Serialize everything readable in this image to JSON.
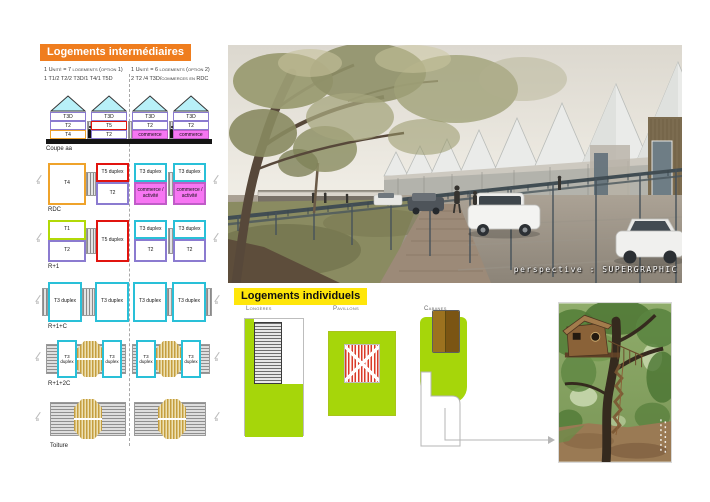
{
  "colors": {
    "orange_title_bg": "#EF7D1E",
    "yellow_title_bg": "#FFE60A",
    "cyan_border": "#29C0D8",
    "cyan_roof_fill": "#B8F0F8",
    "purple_border": "#8B7BD0",
    "red_border": "#E1140F",
    "orange_t4_border": "#EFA32B",
    "lime_green": "#A6D60A",
    "magenta_commerce": "#F776F3",
    "tan_hatch": "#C59E3F"
  },
  "intermediaires": {
    "title": "Logements intermédiaires",
    "legend": {
      "option1_line1": "1 Unité = 7 logements (option 1)",
      "option1_line2": "1 T1/2 T2/2 T3D/1 T4/1 T5D",
      "option2_line1": "1 Unité = 6 logements (option 2)",
      "option2_line2": "2 T2 /4 T3D/commerces en RDC"
    },
    "coupe": {
      "label": "Coupe aa",
      "houses": [
        {
          "roof": "T3D",
          "mid": "T2",
          "bottom": "T4"
        },
        {
          "roof": "T3D",
          "mid": "T5",
          "bottom": "T2"
        },
        {
          "roof": "T3D",
          "mid": "T2",
          "bottom": "commerce"
        },
        {
          "roof": "T3D",
          "mid": "T2",
          "bottom": "commerce"
        }
      ]
    },
    "rdc": {
      "label": "RDC",
      "blocks": [
        {
          "cells": [
            {
              "label": "T4"
            }
          ]
        },
        {
          "cells": [
            {
              "label": "T5 duplex"
            },
            {
              "label": "T2"
            }
          ]
        },
        {
          "cells": [
            {
              "label": "T3 duplex"
            },
            {
              "label": "commerce / activité"
            }
          ]
        },
        {
          "cells": [
            {
              "label": "T3 duplex"
            },
            {
              "label": "commerce / activité"
            }
          ]
        }
      ]
    },
    "r1": {
      "label": "R+1",
      "blocks": [
        {
          "cells": [
            {
              "label": "T1"
            },
            {
              "label": "T2"
            }
          ]
        },
        {
          "cells": [
            {
              "label": "T5 duplex"
            }
          ]
        },
        {
          "cells": [
            {
              "label": "T3 duplex"
            },
            {
              "label": "T2"
            }
          ]
        },
        {
          "cells": [
            {
              "label": "T3 duplex"
            },
            {
              "label": "T2"
            }
          ]
        }
      ]
    },
    "r1c": {
      "label": "R+1+C",
      "unit": "T3 duplex"
    },
    "r12c": {
      "label": "R+1+2C",
      "unit": "T3 duplex"
    },
    "toiture": {
      "label": "Toiture"
    },
    "section_marker": "a"
  },
  "perspective": {
    "caption": "perspective : SUPERGRAPHIC"
  },
  "individuels": {
    "title": "Logements individuels",
    "types": [
      {
        "label": "Longères"
      },
      {
        "label": "Pavillons"
      },
      {
        "label": "Cabanes"
      }
    ]
  }
}
